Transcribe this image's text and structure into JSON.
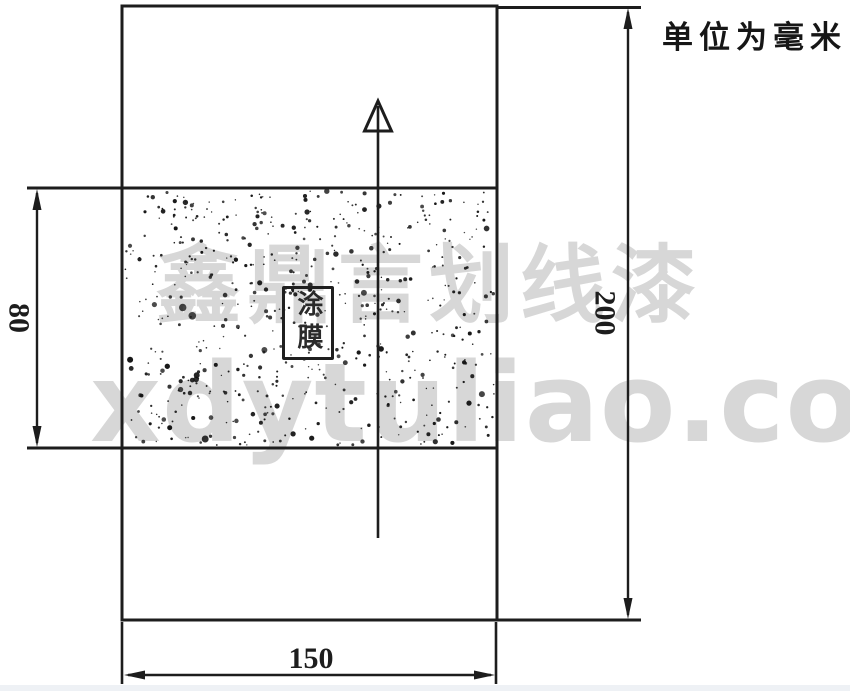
{
  "diagram": {
    "unit_note": "单位为毫米",
    "coating_film_label": "涂膜",
    "dimensions": {
      "specimen_width_mm": "150",
      "specimen_height_mm": "200",
      "coating_band_height_mm": "80"
    }
  },
  "watermark": {
    "line1": "鑫鼎言划线漆",
    "line2": "xdytuliao.com"
  },
  "colors": {
    "line": "#1d1d1d",
    "watermark": "rgba(201,201,201,0.75)",
    "background": "#ffffff",
    "footer_strip": "#eef1f5"
  }
}
